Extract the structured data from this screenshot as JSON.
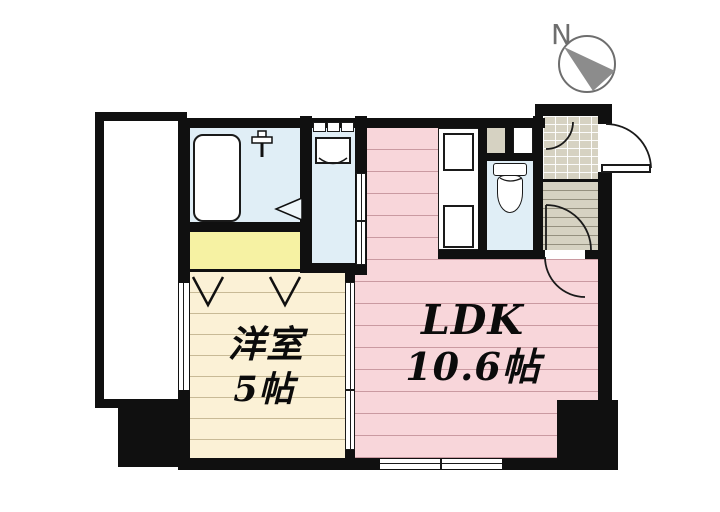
{
  "compass": {
    "direction_label": "N"
  },
  "rooms": {
    "western_room": {
      "name": "洋室",
      "size": "5帖"
    },
    "ldk": {
      "name": "LDK",
      "size": "10.6帖"
    }
  },
  "fixtures": {
    "bathtub": "bathtub-icon",
    "shower": "shower-faucet-icon",
    "washing_machine": "washing-machine-icon",
    "toilet": "toilet-icon",
    "kitchen_sink": "kitchen-sink",
    "kitchen_stove": "kitchen-stove",
    "closet": "closet",
    "entrance": "entrance-tile",
    "hallway": "hallway",
    "balcony": "balcony"
  },
  "colors": {
    "ldk_pink": "#f8d6da",
    "western_room_cream": "#fbf1d6",
    "water_blue": "#e0eef6",
    "closet_yellow": "#f6f2a3",
    "tile_beige": "#d6d2c2",
    "wall_black": "#101010",
    "compass_gray": "#8c8c8c"
  }
}
